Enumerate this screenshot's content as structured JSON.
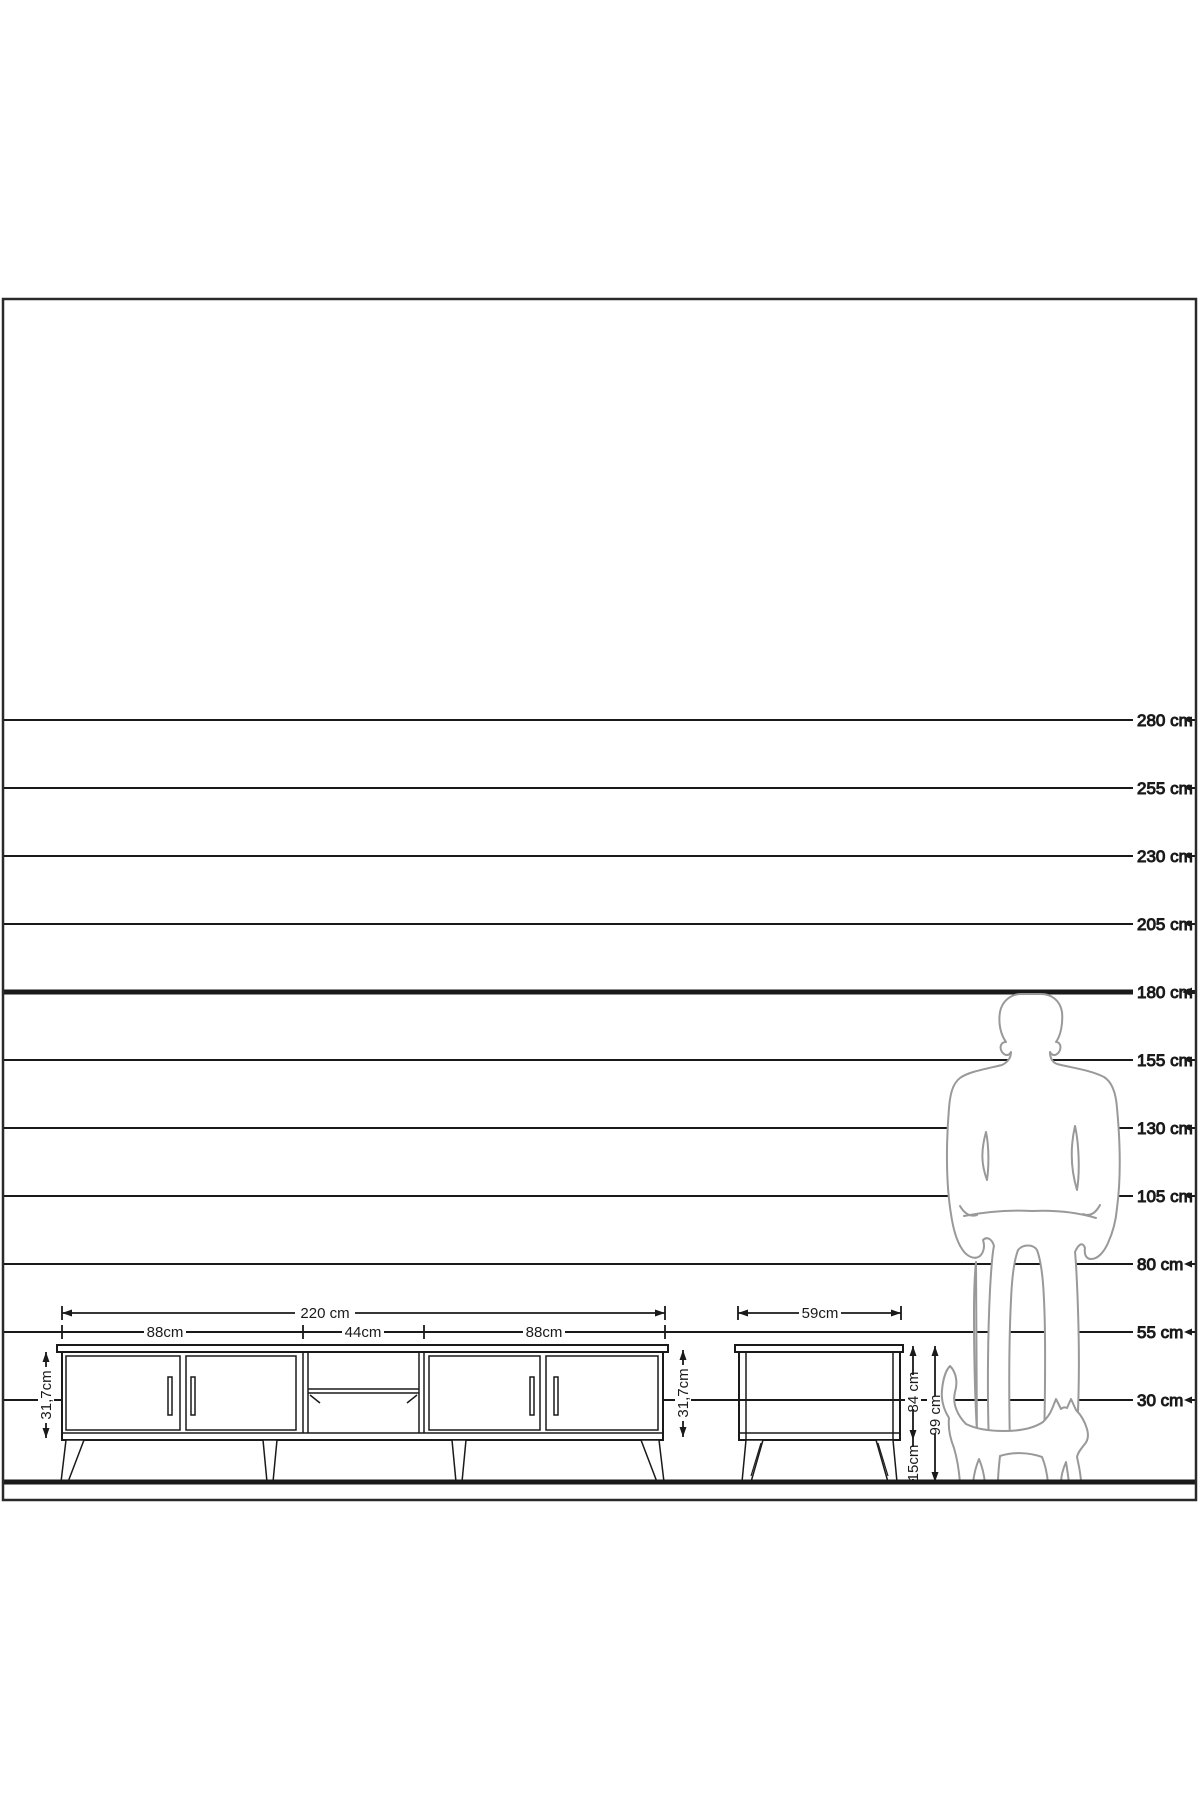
{
  "diagram": {
    "type": "furniture-scale-elevation",
    "unit": "cm",
    "colors": {
      "line": "#1a1a1a",
      "frame": "#2a2a2a",
      "figure_outline": "#999999",
      "background": "#ffffff"
    },
    "scale": {
      "lines": [
        {
          "cm": 280,
          "label": "280 cm"
        },
        {
          "cm": 255,
          "label": "255 cm"
        },
        {
          "cm": 230,
          "label": "230 cm"
        },
        {
          "cm": 205,
          "label": "205 cm"
        },
        {
          "cm": 180,
          "label": "180 cm",
          "emphasis": true
        },
        {
          "cm": 155,
          "label": "155 cm"
        },
        {
          "cm": 130,
          "label": "130 cm"
        },
        {
          "cm": 105,
          "label": "105 cm"
        },
        {
          "cm": 80,
          "label": "80 cm"
        },
        {
          "cm": 55,
          "label": "55 cm"
        },
        {
          "cm": 30,
          "label": "30 cm"
        }
      ]
    },
    "tv_stand": {
      "name": "tv-stand-front-elevation",
      "total_width_label": "220 cm",
      "sections": [
        {
          "label": "88cm"
        },
        {
          "label": "44cm"
        },
        {
          "label": "88cm"
        }
      ],
      "body_height_left_label": "31,7cm",
      "body_height_right_label": "31,7cm"
    },
    "side_table": {
      "name": "side-table-front-elevation",
      "width_label": "59cm",
      "height_a_label": "84 cm",
      "height_b_label": "99 cm",
      "leg_height_label": "15cm"
    },
    "figures": {
      "man": "human-silhouette-for-scale",
      "cat": "cat-silhouette-for-scale"
    }
  }
}
